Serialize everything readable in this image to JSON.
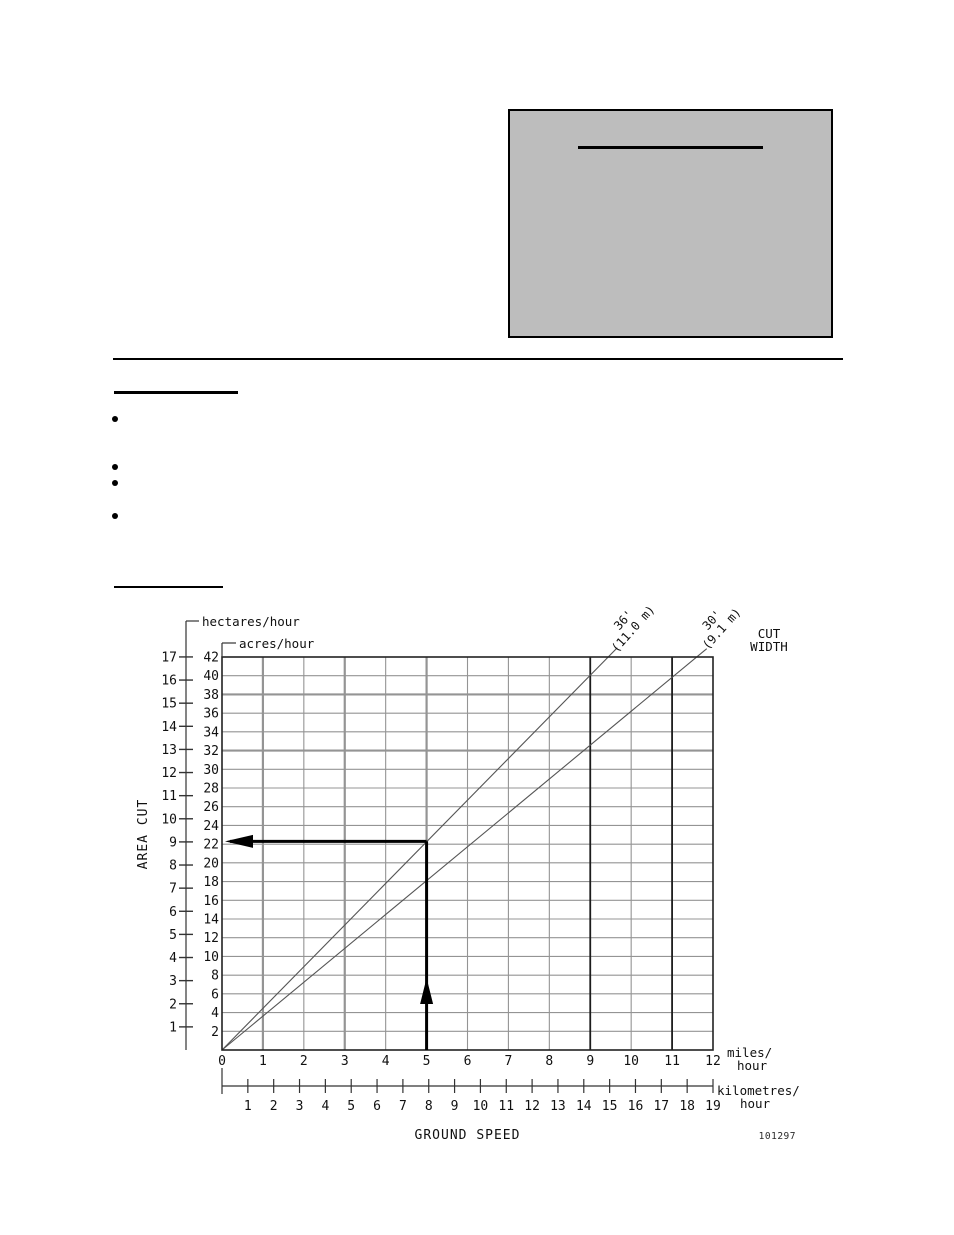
{
  "chart_data": {
    "type": "line",
    "title": "",
    "xlabel": "GROUND SPEED",
    "ylabel": "AREA CUT",
    "footnote": "101297",
    "cut_width_heading": {
      "line1": "CUT",
      "line2": "WIDTH"
    },
    "axes": {
      "acres": {
        "label": "acres/hour",
        "ticks": [
          2,
          4,
          6,
          8,
          10,
          12,
          14,
          16,
          18,
          20,
          22,
          24,
          26,
          28,
          30,
          32,
          34,
          36,
          38,
          40,
          42
        ],
        "min": 0,
        "max": 42
      },
      "hectares": {
        "label": "hectares/hour",
        "ticks": [
          1,
          2,
          3,
          4,
          5,
          6,
          7,
          8,
          9,
          10,
          11,
          12,
          13,
          14,
          15,
          16,
          17
        ],
        "acres_per_hectare": 2.471
      },
      "miles": {
        "label_line1": "miles/",
        "label_line2": "hour",
        "ticks": [
          0,
          1,
          2,
          3,
          4,
          5,
          6,
          7,
          8,
          9,
          10,
          11,
          12
        ],
        "min": 0,
        "max": 12
      },
      "km": {
        "label_line1": "kilometres/",
        "label_line2": "hour",
        "ticks": [
          1,
          2,
          3,
          4,
          5,
          6,
          7,
          8,
          9,
          10,
          11,
          12,
          13,
          14,
          15,
          16,
          17,
          18,
          19
        ],
        "max": 19
      }
    },
    "series": [
      {
        "name": "36' (11.0 m)",
        "label_line1": "36'",
        "label_line2": "(11.0 m)",
        "acres_per_mph": 4.45
      },
      {
        "name": "30' (9.1 m)",
        "label_line1": "30'",
        "label_line2": "(9.1 m)",
        "acres_per_mph": 3.62
      }
    ],
    "example_trace": {
      "speed_mph": 5,
      "acres_per_hour": 22.3,
      "hectares_per_hour": 9
    },
    "layout": {
      "grid": true,
      "thick_gray_h_acres": [
        38,
        32
      ],
      "thick_gray_v_miles": [
        1,
        3,
        5
      ],
      "dark_v_miles": [
        9,
        11
      ],
      "legend_position": "top-right-rotated"
    }
  }
}
